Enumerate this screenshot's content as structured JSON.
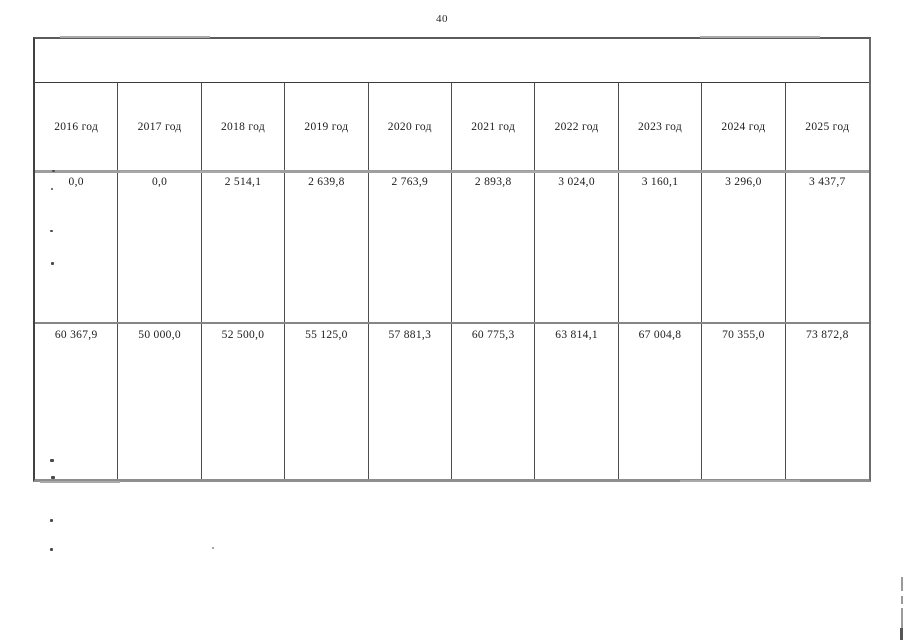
{
  "page": {
    "number": "40"
  },
  "table": {
    "columns": [
      "2016 год",
      "2017 год",
      "2018 год",
      "2019 год",
      "2020 год",
      "2021 год",
      "2022 год",
      "2023 год",
      "2024 год",
      "2025 год"
    ],
    "rows": [
      {
        "values": [
          "0,0",
          "0,0",
          "2 514,1",
          "2 639,8",
          "2 763,9",
          "2 893,8",
          "3 024,0",
          "3 160,1",
          "3 296,0",
          "3 437,7"
        ]
      },
      {
        "values": [
          "60 367,9",
          "50 000,0",
          "52 500,0",
          "55 125,0",
          "57 881,3",
          "60 775,3",
          "63 814,1",
          "67 004,8",
          "70 355,0",
          "73 872,8"
        ]
      }
    ]
  }
}
